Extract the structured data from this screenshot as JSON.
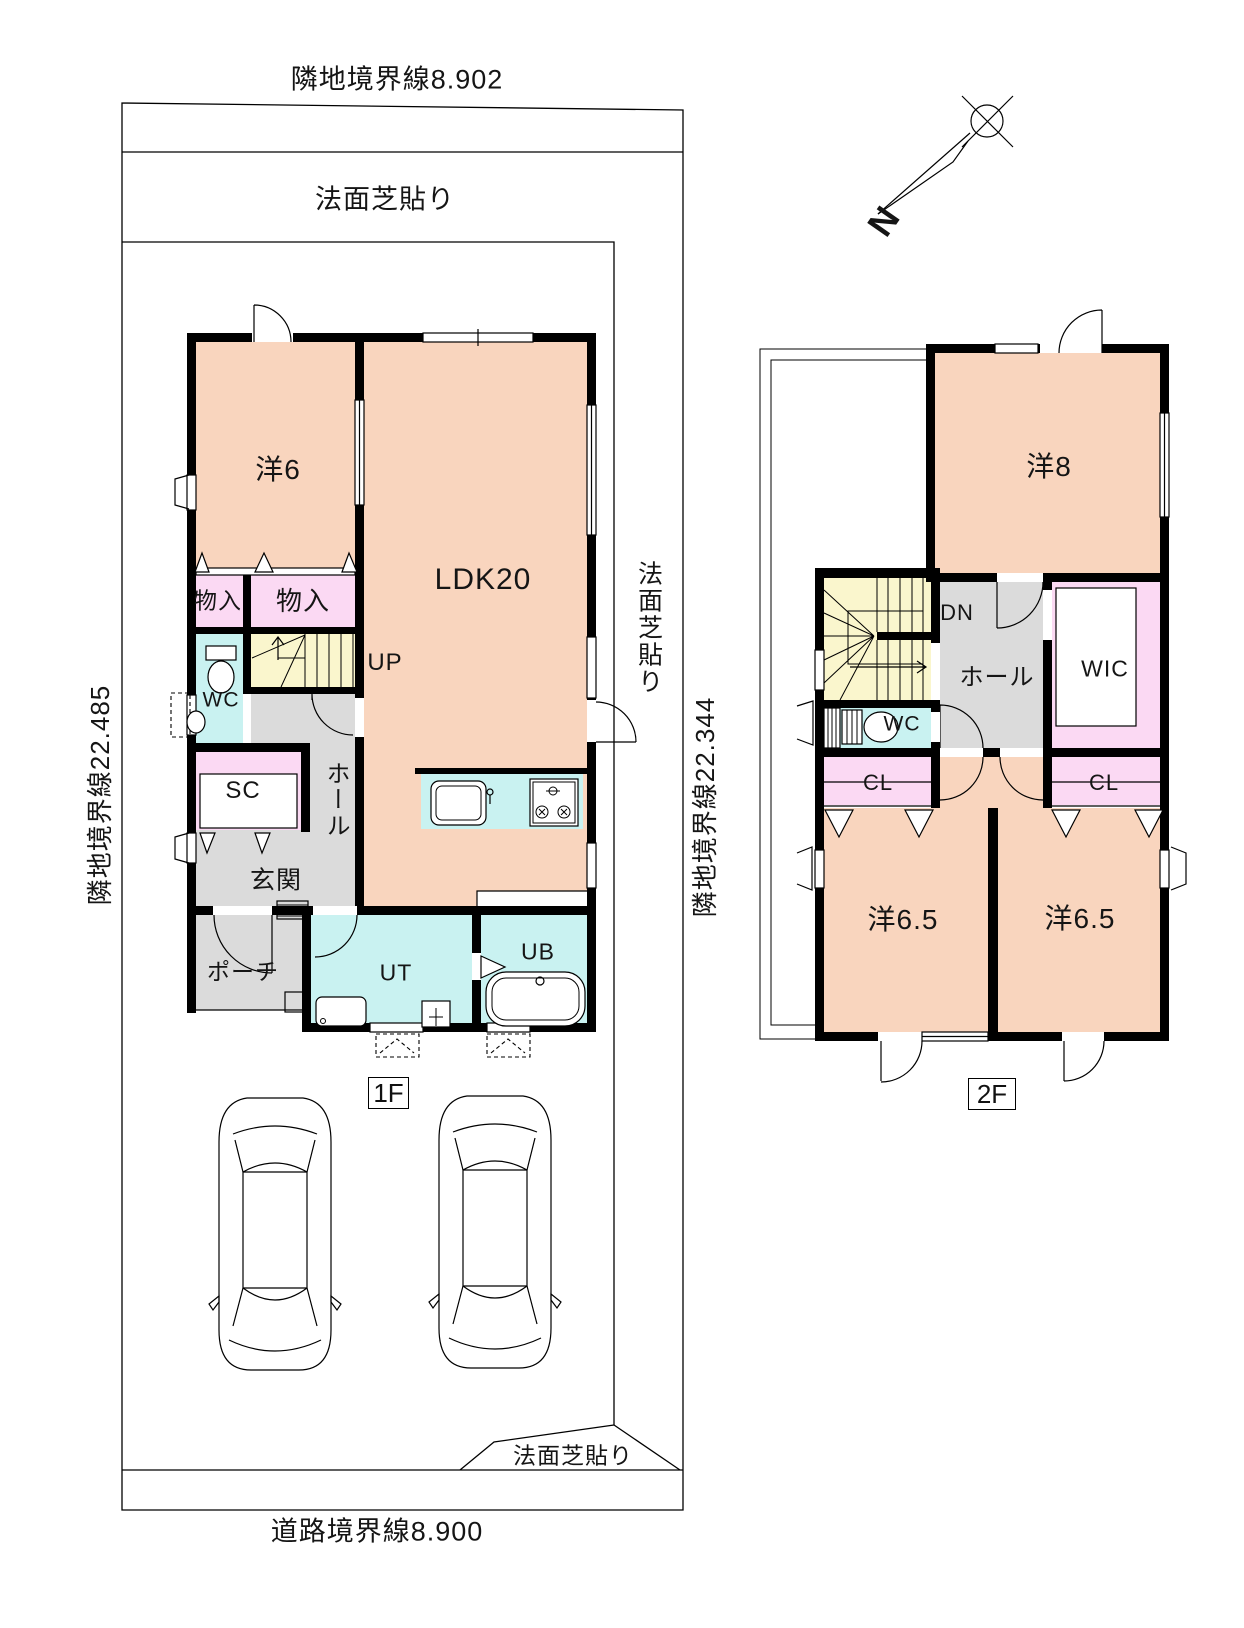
{
  "palette": {
    "room": "#F9D5BE",
    "closet": "#FBD9F3",
    "wet": "#C9F2F1",
    "stairs": "#FAF6CD",
    "hall": "#DBDBDB",
    "wall": "#000000",
    "paper": "#FFFFFF"
  },
  "site": {
    "top_boundary": "隣地境界線8.902",
    "left_boundary": "隣地境界線22.485",
    "right_boundary": "隣地境界線22.344",
    "road_boundary": "道路境界線8.900",
    "slope_top": "法面芝貼り",
    "slope_right": "法面芝貼り",
    "slope_bottom": "法面芝貼り",
    "north_label": "N"
  },
  "floor1": {
    "floor_label": "1F",
    "rooms": {
      "yo6": "洋6",
      "ldk": "LDK20",
      "mono1": "物入",
      "mono2": "物入",
      "up": "UP",
      "wc": "WC",
      "sc": "SC",
      "hall": "ホール",
      "genkan": "玄関",
      "porch": "ポーチ",
      "ut": "UT",
      "ub": "UB"
    }
  },
  "floor2": {
    "floor_label": "2F",
    "rooms": {
      "yo8": "洋8",
      "dn": "DN",
      "hall": "ホール",
      "wic": "WIC",
      "wc": "WC",
      "cl1": "CL",
      "cl2": "CL",
      "yo65a": "洋6.5",
      "yo65b": "洋6.5"
    }
  }
}
